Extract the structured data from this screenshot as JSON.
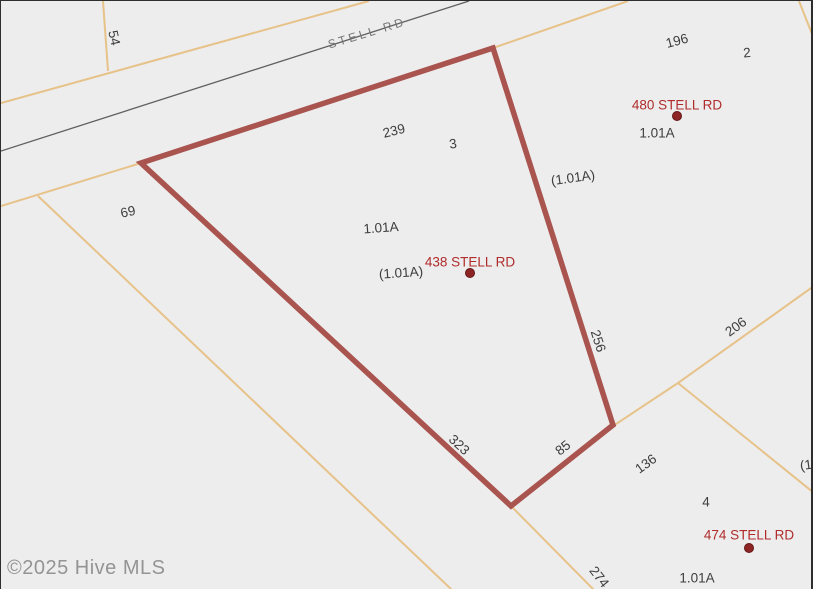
{
  "map": {
    "road": {
      "label": "STELL RD"
    },
    "watermark": "©2025 Hive MLS",
    "highlighted_parcel": {
      "address": "438 STELL RD",
      "lot": "3",
      "acreage": "1.01A",
      "acreage_paren": "(1.01A)",
      "edge_lengths": [
        "239",
        "256",
        "85",
        "323"
      ]
    },
    "other_addresses": [
      {
        "address": "480 STELL RD",
        "lot": "2",
        "acreage": "1.01A"
      },
      {
        "address": "474 STELL RD",
        "lot": "4",
        "acreage": "1.01A"
      }
    ]
  },
  "labels": [
    {
      "name": "road-name-label",
      "text": "STELL RD",
      "cls": "road",
      "x": 366,
      "y": 32,
      "rot": -17
    },
    {
      "name": "dim-label-54",
      "text": "54",
      "cls": "dim",
      "x": 113,
      "y": 37,
      "rot": 78
    },
    {
      "name": "dim-label-69",
      "text": "69",
      "cls": "dim",
      "x": 127,
      "y": 211,
      "rot": -12
    },
    {
      "name": "dim-label-239",
      "text": "239",
      "cls": "dim",
      "x": 393,
      "y": 130,
      "rot": -14
    },
    {
      "name": "lot-label-3",
      "text": "3",
      "cls": "dim",
      "x": 452,
      "y": 143,
      "rot": -8
    },
    {
      "name": "dim-label-196",
      "text": "196",
      "cls": "dim",
      "x": 676,
      "y": 40,
      "rot": -15
    },
    {
      "name": "lot-label-2",
      "text": "2",
      "cls": "dim",
      "x": 746,
      "y": 52,
      "rot": -5
    },
    {
      "name": "address-label-480-stell-rd",
      "text": "480 STELL RD",
      "cls": "addr",
      "x": 676,
      "y": 104,
      "rot": 0
    },
    {
      "name": "area-label-480",
      "text": "1.01A",
      "cls": "area",
      "x": 656,
      "y": 132,
      "rot": 0
    },
    {
      "name": "area-label-paren-right",
      "text": "(1.01A)",
      "cls": "area",
      "x": 572,
      "y": 177,
      "rot": -8
    },
    {
      "name": "area-label-438",
      "text": "1.01A",
      "cls": "area",
      "x": 380,
      "y": 227,
      "rot": -4
    },
    {
      "name": "address-label-438-stell-rd",
      "text": "438 STELL RD",
      "cls": "addr",
      "x": 469,
      "y": 261,
      "rot": 0
    },
    {
      "name": "area-label-paren-438",
      "text": "(1.01A)",
      "cls": "area",
      "x": 400,
      "y": 272,
      "rot": -4
    },
    {
      "name": "dim-label-256",
      "text": "256",
      "cls": "dim",
      "x": 597,
      "y": 340,
      "rot": 72
    },
    {
      "name": "dim-label-206",
      "text": "206",
      "cls": "dim",
      "x": 735,
      "y": 326,
      "rot": -36
    },
    {
      "name": "dim-label-136",
      "text": "136",
      "cls": "dim",
      "x": 645,
      "y": 463,
      "rot": -36
    },
    {
      "name": "dim-label-85",
      "text": "85",
      "cls": "dim",
      "x": 562,
      "y": 447,
      "rot": -38
    },
    {
      "name": "dim-label-323",
      "text": "323",
      "cls": "dim",
      "x": 458,
      "y": 444,
      "rot": 43
    },
    {
      "name": "dim-label-274",
      "text": "274",
      "cls": "dim",
      "x": 598,
      "y": 576,
      "rot": 52
    },
    {
      "name": "lot-label-4",
      "text": "4",
      "cls": "dim",
      "x": 705,
      "y": 501,
      "rot": 0
    },
    {
      "name": "address-label-474-stell-rd",
      "text": "474 STELL RD",
      "cls": "addr",
      "x": 748,
      "y": 534,
      "rot": 0
    },
    {
      "name": "area-label-474",
      "text": "1.01A",
      "cls": "area",
      "x": 696,
      "y": 577,
      "rot": 0
    },
    {
      "name": "area-label-paren-clipped",
      "text": "(1.01A)",
      "cls": "area",
      "x": 821,
      "y": 462,
      "rot": -8
    }
  ],
  "markers": [
    {
      "name": "parcel-marker-480",
      "x": 676,
      "y": 115
    },
    {
      "name": "parcel-marker-438",
      "x": 469,
      "y": 272
    },
    {
      "name": "parcel-marker-474",
      "x": 748,
      "y": 547
    }
  ],
  "geometry": {
    "road_centerline": [
      [
        0,
        150
      ],
      [
        468,
        0
      ]
    ],
    "parcel_lines": [
      {
        "name": "road-north-edge-line",
        "points": [
          [
            0,
            102
          ],
          [
            368,
            0
          ]
        ]
      },
      {
        "name": "west-lot-division-line",
        "points": [
          [
            102,
            0
          ],
          [
            107,
            70
          ]
        ]
      },
      {
        "name": "road-south-boundary-line",
        "points": [
          [
            0,
            205
          ],
          [
            140,
            162
          ],
          [
            492,
            47
          ],
          [
            627,
            0
          ]
        ]
      },
      {
        "name": "southwest-diagonal-line",
        "points": [
          [
            37,
            195
          ],
          [
            451,
            589
          ]
        ]
      },
      {
        "name": "lot4-northwest-boundary",
        "points": [
          [
            677,
            382
          ],
          [
            612,
            425
          ],
          [
            510,
            505
          ],
          [
            593,
            589
          ]
        ]
      },
      {
        "name": "dim-206-boundary-line",
        "points": [
          [
            677,
            382
          ],
          [
            813,
            285
          ]
        ]
      },
      {
        "name": "lot4-northeast-boundary",
        "points": [
          [
            677,
            382
          ],
          [
            813,
            492
          ]
        ]
      },
      {
        "name": "top-right-corner-line",
        "points": [
          [
            798,
            0
          ],
          [
            813,
            38
          ]
        ]
      }
    ],
    "highlight_polygon": [
      [
        140,
        162
      ],
      [
        492,
        47
      ],
      [
        612,
        424
      ],
      [
        510,
        505
      ]
    ]
  },
  "colors": {
    "background": "#ededed",
    "parcel_line": "#e7c289",
    "road_line": "#606060",
    "highlight_outline": "#a9544f",
    "marker_fill": "#8e2525",
    "address_text": "#b02c2c",
    "label_text": "#3d3d3d",
    "road_text": "#767676",
    "watermark_text": "#949494"
  }
}
